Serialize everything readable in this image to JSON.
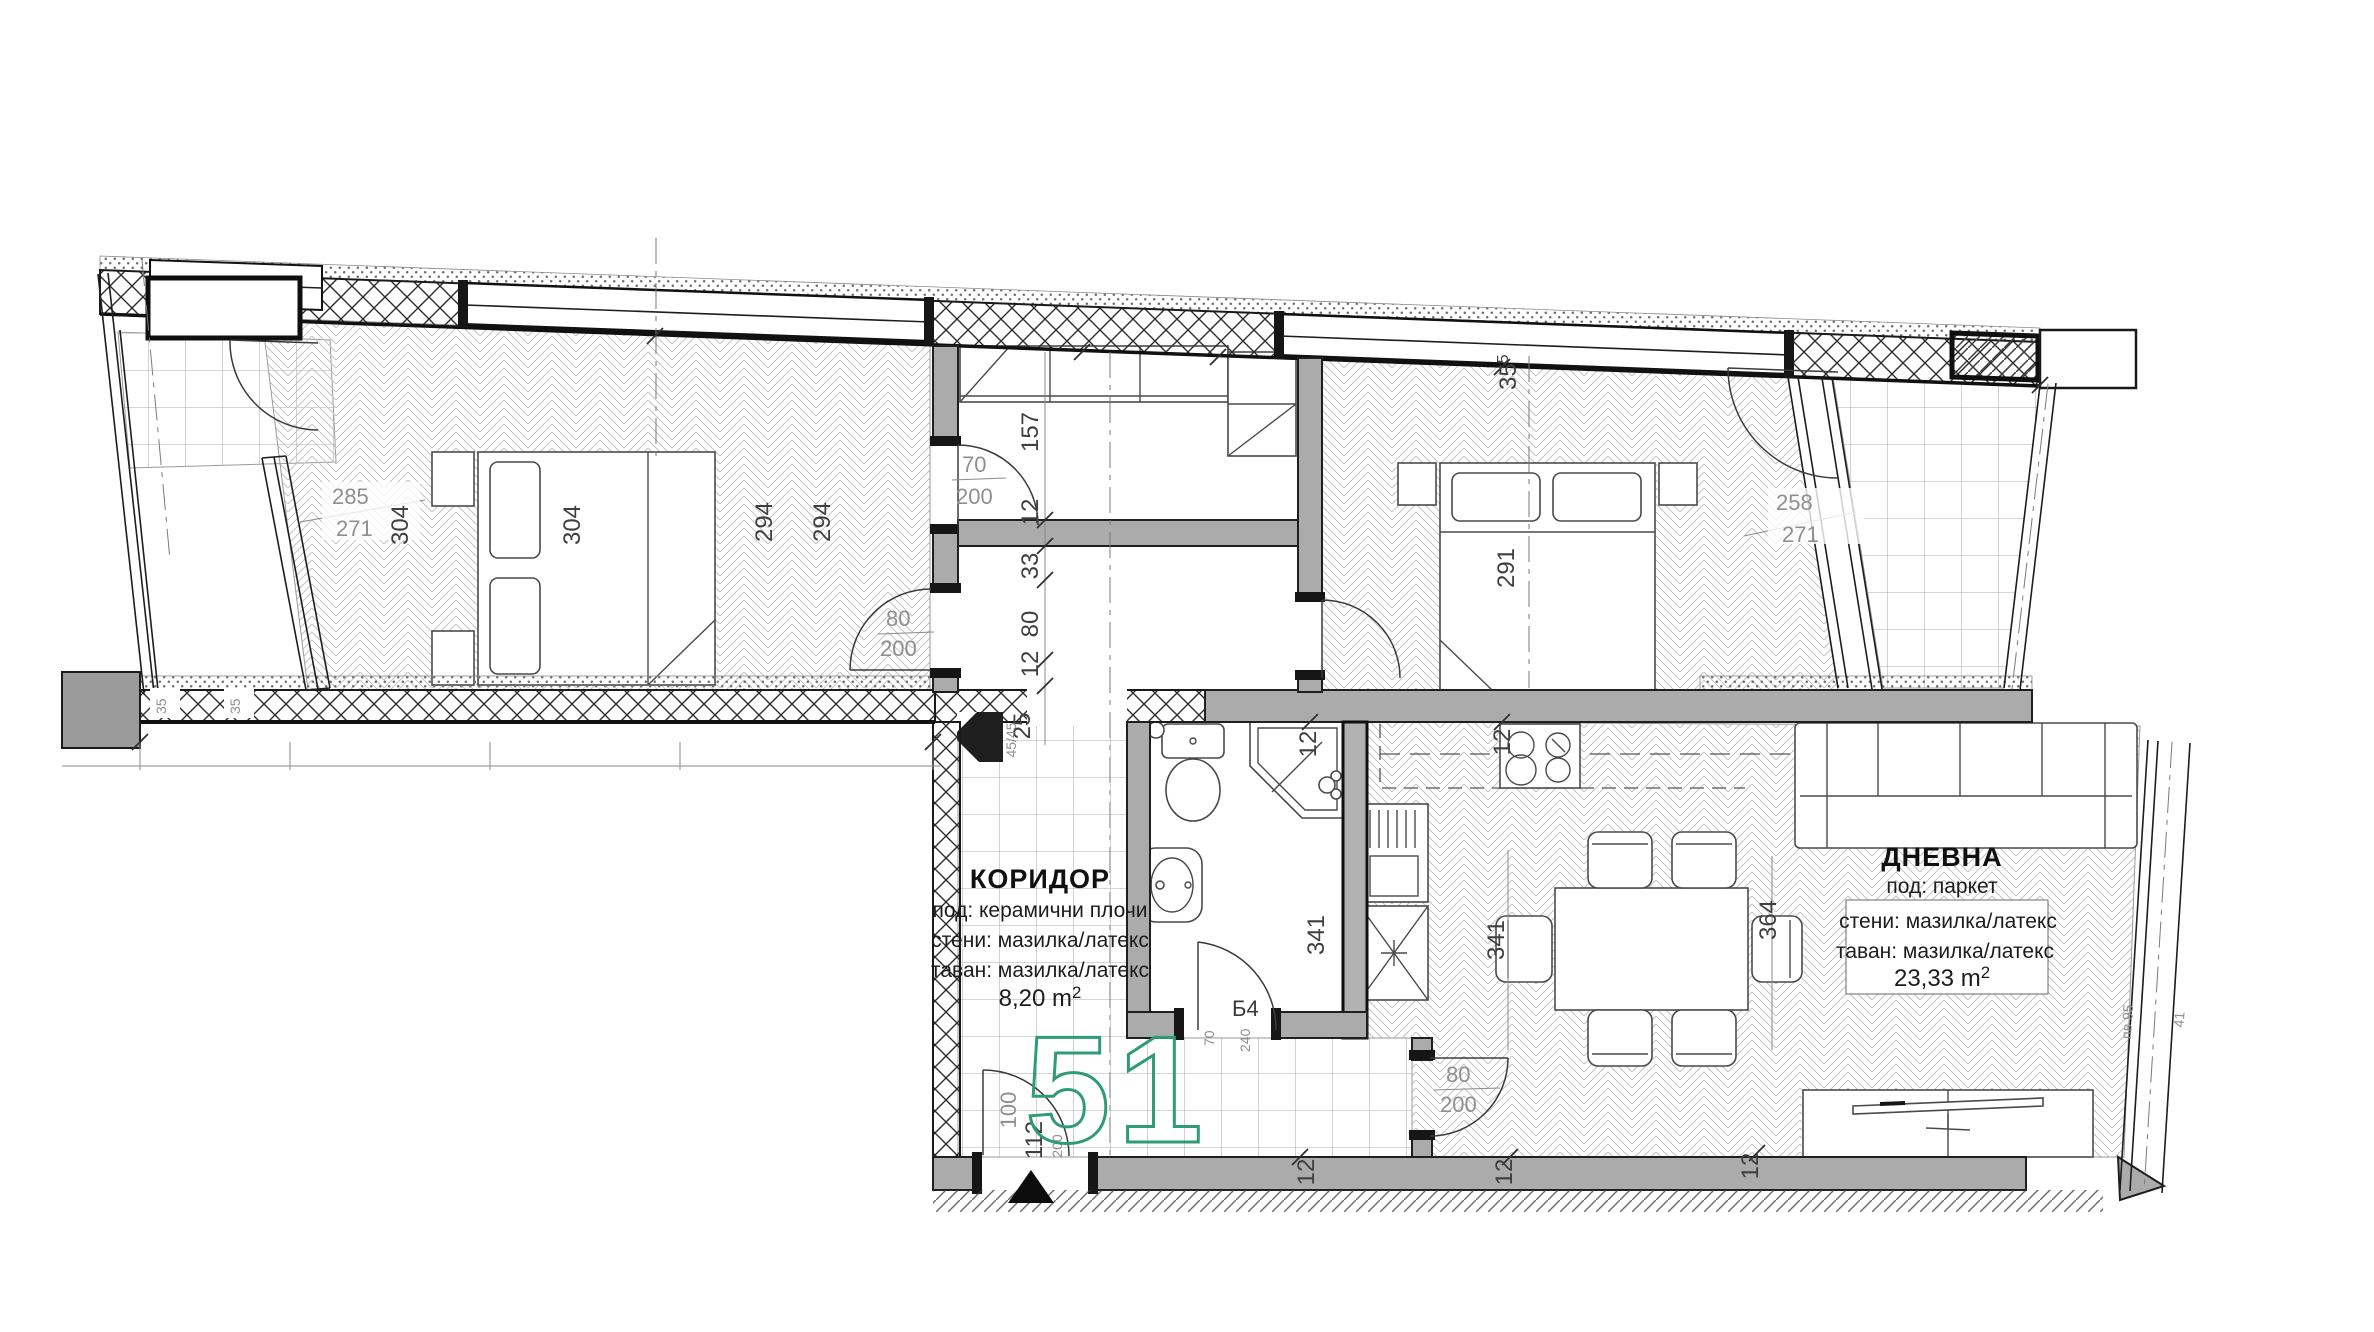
{
  "colors": {
    "accent_green": "#2F9B78",
    "interior_wall": "#ABABAB",
    "exterior_hatch_line": "#2C2C2C",
    "dim_text": "#8F8F8F",
    "chain_text": "#3F3F3F",
    "line": "#1F1F1F"
  },
  "labels": {
    "apartment_number": "51",
    "corridor": {
      "name": "КОРИДОР",
      "floor": "под: керамични плочи",
      "walls": "стени: мазилка/латекс",
      "ceiling": "таван: мазилка/латекс",
      "area": "8,20 m",
      "area_sup": "2"
    },
    "living": {
      "name": "ДНЕВНА",
      "floor": "под: паркет",
      "walls": "стени: мазилка/латекс",
      "ceiling": "таван: мазилка/латекс",
      "area": "23,33 m",
      "area_sup": "2"
    },
    "bath_door": "Б4"
  },
  "dims": {
    "win_left_top": "285",
    "win_left_bottom": "271",
    "b1_w1": "304",
    "b1_w2": "304",
    "b1_d1": "294",
    "b1_d2": "294",
    "closet_h": "157",
    "chain_12a": "12",
    "chain_33": "33",
    "chain_80": "80",
    "chain_12b": "12",
    "chain_25": "25",
    "door_closet_w": "70",
    "door_closet_h": "200",
    "door_b1_w": "80",
    "door_b1_h": "200",
    "b2_off": "35",
    "b2_off_sup": "5",
    "b2_w": "291",
    "win_right_top": "258",
    "win_right_bottom": "271",
    "bath_12": "12",
    "bath_d": "341",
    "kitchen_12": "12",
    "dining_d1": "341",
    "dining_d2": "364",
    "door_dining_w": "80",
    "door_dining_h": "200",
    "bath_door_w": "70",
    "bath_door_h": "240",
    "bottom_12a": "12",
    "bottom_12b": "12",
    "bottom_12c": "12",
    "entry_w": "100",
    "entry_door": "112",
    "entry_door_h": "200",
    "column": "45/45",
    "wall_35a": "35",
    "wall_35b": "35",
    "win_pv": "пв 95",
    "win_41": "41"
  }
}
